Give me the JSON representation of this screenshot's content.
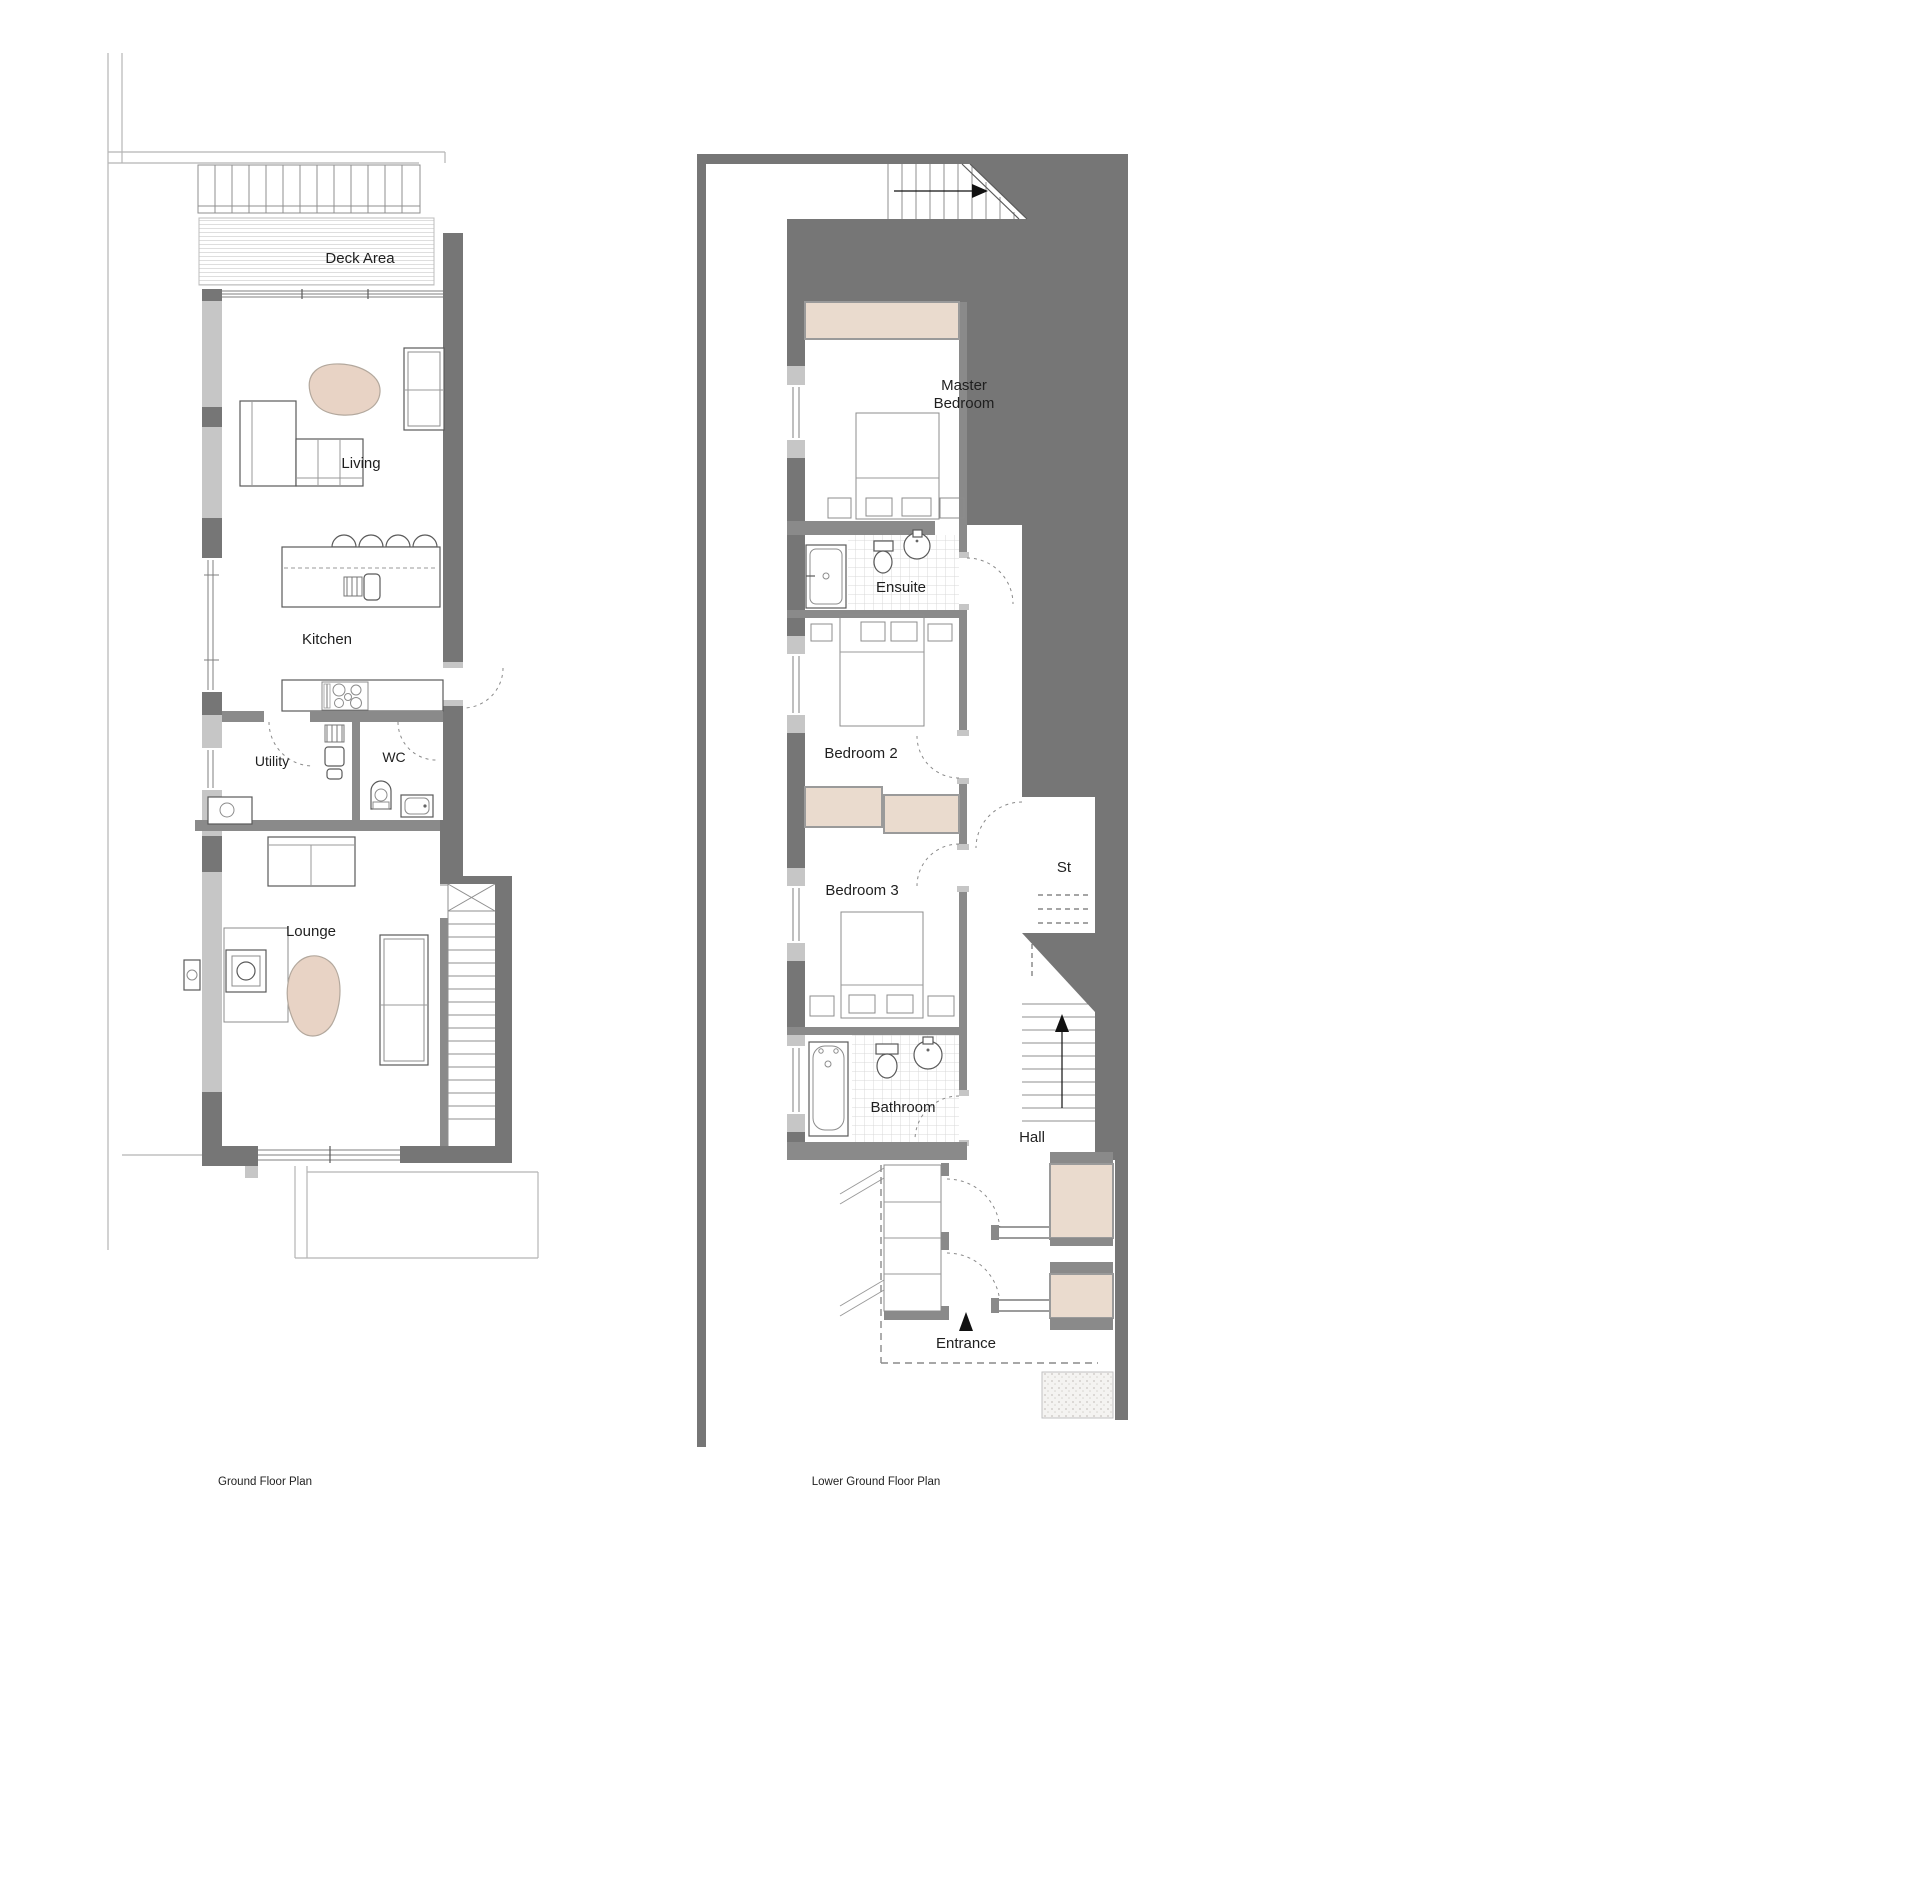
{
  "ground_floor": {
    "caption": "Ground Floor Plan",
    "rooms": {
      "deck": "Deck Area",
      "living": "Living",
      "kitchen": "Kitchen",
      "utility": "Utility",
      "wc": "WC",
      "lounge": "Lounge"
    }
  },
  "lower_ground_floor": {
    "caption": "Lower Ground Floor Plan",
    "rooms": {
      "master_line1": "Master",
      "master_line2": "Bedroom",
      "ensuite": "Ensuite",
      "bedroom2": "Bedroom 2",
      "bedroom3": "Bedroom 3",
      "storage": "St",
      "bathroom": "Bathroom",
      "hall": "Hall",
      "entrance": "Entrance"
    }
  },
  "colors": {
    "wall_dark": "#767676",
    "wall_medium": "#8a8a8a",
    "wall_light": "#c6c6c6",
    "wardrobe_beige": "#eadbce",
    "rug_beige": "#e8d3c5",
    "line": "#5a5a5a",
    "boundary": "#b5b5b5",
    "tile": "#d9d9d9",
    "text": "#1f1f1f"
  }
}
